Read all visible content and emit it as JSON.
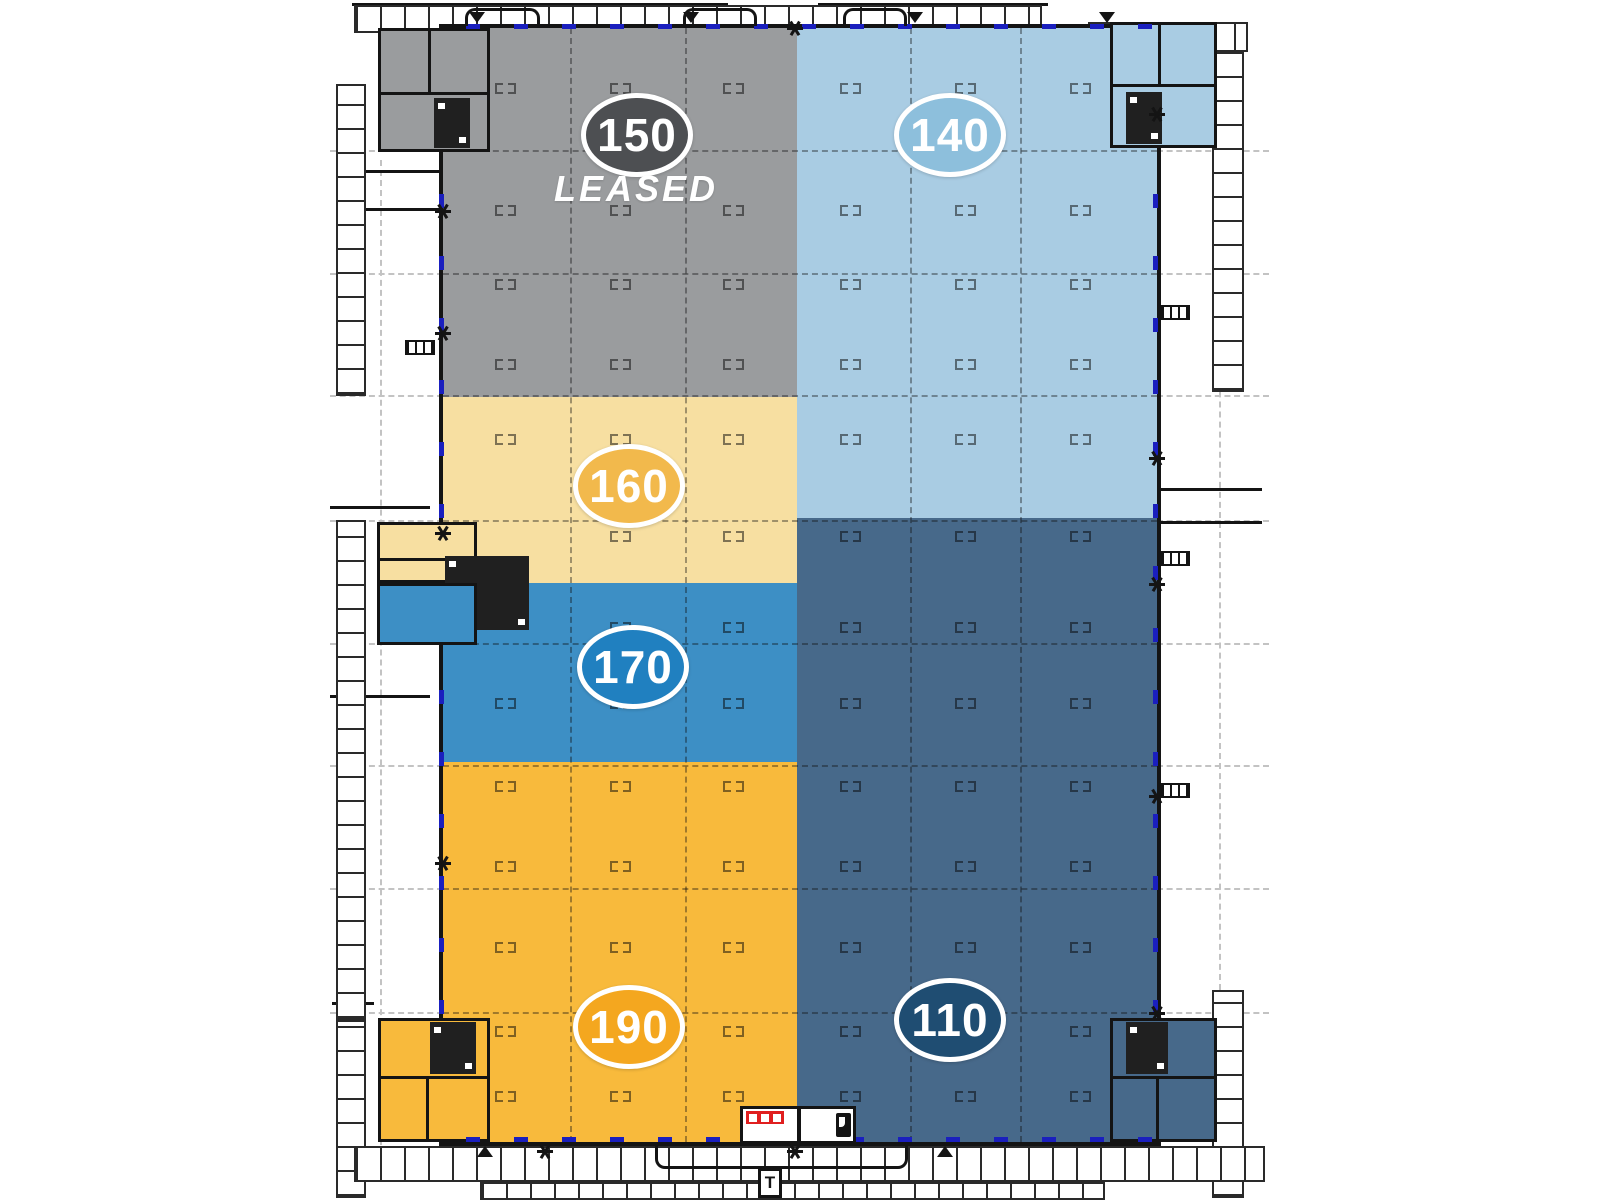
{
  "diagram": {
    "type": "industrial-building-floor-plan",
    "suites": [
      {
        "id": "150",
        "label": "150",
        "status": "LEASED",
        "fill": "#9a9c9e",
        "badge_fill": "#4d4f52"
      },
      {
        "id": "140",
        "label": "140",
        "status": "",
        "fill": "#a9cce3",
        "badge_fill": "#8dbfdc"
      },
      {
        "id": "160",
        "label": "160",
        "status": "",
        "fill": "#f7dfa1",
        "badge_fill": "#f2b94c"
      },
      {
        "id": "170",
        "label": "170",
        "status": "",
        "fill": "#3d8fc5",
        "badge_fill": "#2080c0"
      },
      {
        "id": "190",
        "label": "190",
        "status": "",
        "fill": "#f8ba3c",
        "badge_fill": "#f4a71f"
      },
      {
        "id": "110",
        "label": "110",
        "status": "",
        "fill": "#47698a",
        "badge_fill": "#1f4d72"
      }
    ],
    "labels": {
      "leased": "LEASED",
      "transformer": "T"
    },
    "colors": {
      "wall": "#141414",
      "dock_door_dash": "#1a1fbe",
      "site_line": "#c3c3c3",
      "electrical_panel_red": "#e01f1f",
      "background": "#ffffff",
      "badge_ring": "#ffffff",
      "badge_text": "#ffffff"
    },
    "icons": {
      "column-marker": "paired-bracket-squares",
      "exit-star": "asterisk-burst",
      "stair": "ladder-hatch",
      "door-arrow": "solid-triangle",
      "dock-door": "blue-dash-on-wall",
      "electrical-panel": "red-panel-white-switches",
      "door": "black-leaf-with-white-swing",
      "transformer": "boxed-letter"
    }
  }
}
